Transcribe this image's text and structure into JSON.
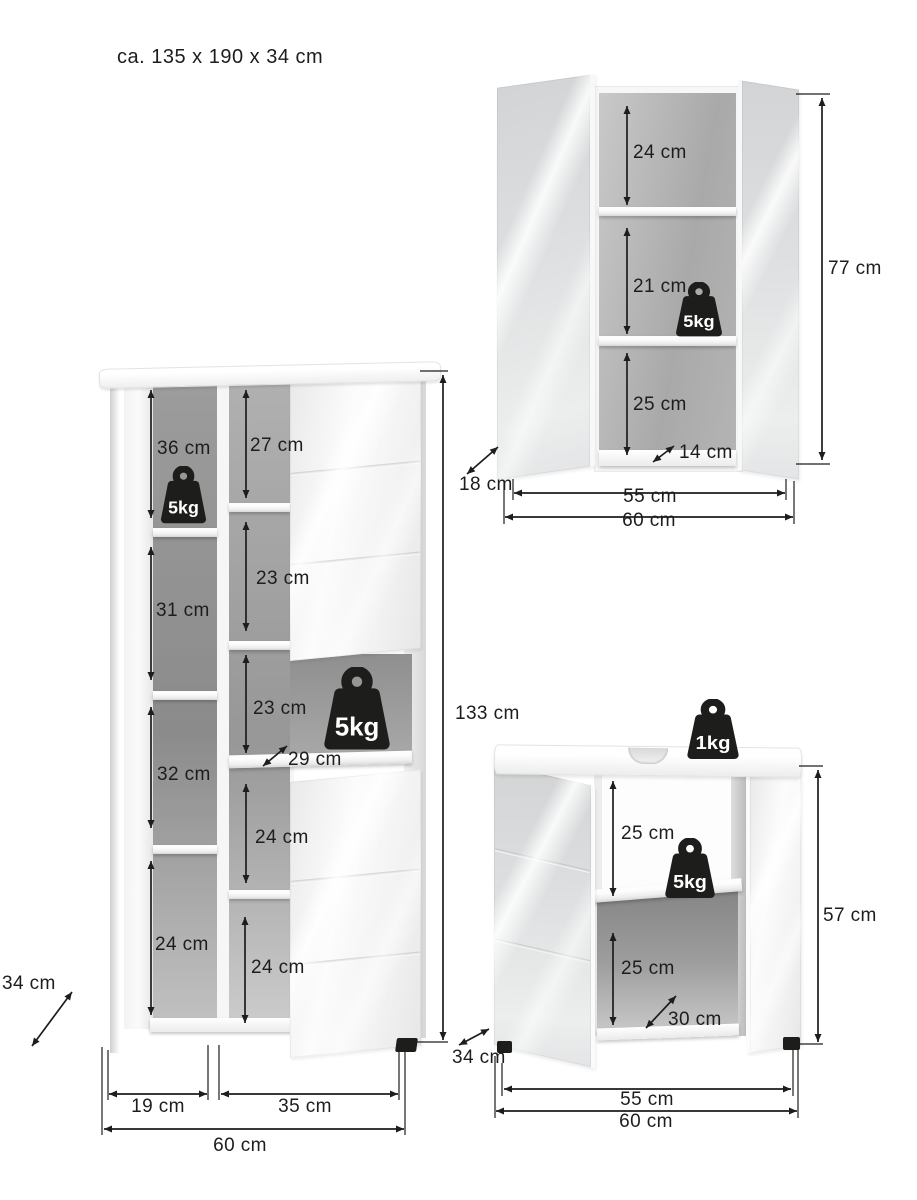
{
  "title": "ca. 135 x 190 x 34 cm",
  "colors": {
    "ink": "#1d1d1b",
    "interior_gray": "#9a9a9a",
    "door_white": "#f7f7f7",
    "mirror_gray": "#dcdedf"
  },
  "tall_cabinet": {
    "left_column": [
      "36 cm",
      "31 cm",
      "32 cm",
      "24 cm"
    ],
    "middle_column": [
      "27 cm",
      "23 cm",
      "23 cm",
      "24 cm",
      "24 cm"
    ],
    "shelf_weights": [
      "5kg",
      "5kg"
    ],
    "inner_depth": "29 cm",
    "height": "133 cm",
    "depth": "34 cm",
    "left_width": "19 cm",
    "right_width": "35 cm",
    "width": "60 cm"
  },
  "mirror_cabinet": {
    "compartments": [
      "24 cm",
      "21 cm",
      "25 cm"
    ],
    "shelf_weight": "5kg",
    "inner_depth": "14 cm",
    "door_depth": "18 cm",
    "height": "77 cm",
    "inner_width": "55 cm",
    "width": "60 cm"
  },
  "sink_cabinet": {
    "top_weight": "1kg",
    "shelf_weight": "5kg",
    "compartments": [
      "25 cm",
      "25 cm"
    ],
    "inner_depth": "30 cm",
    "depth": "34 cm",
    "height": "57 cm",
    "inner_width": "55 cm",
    "width": "60 cm"
  }
}
